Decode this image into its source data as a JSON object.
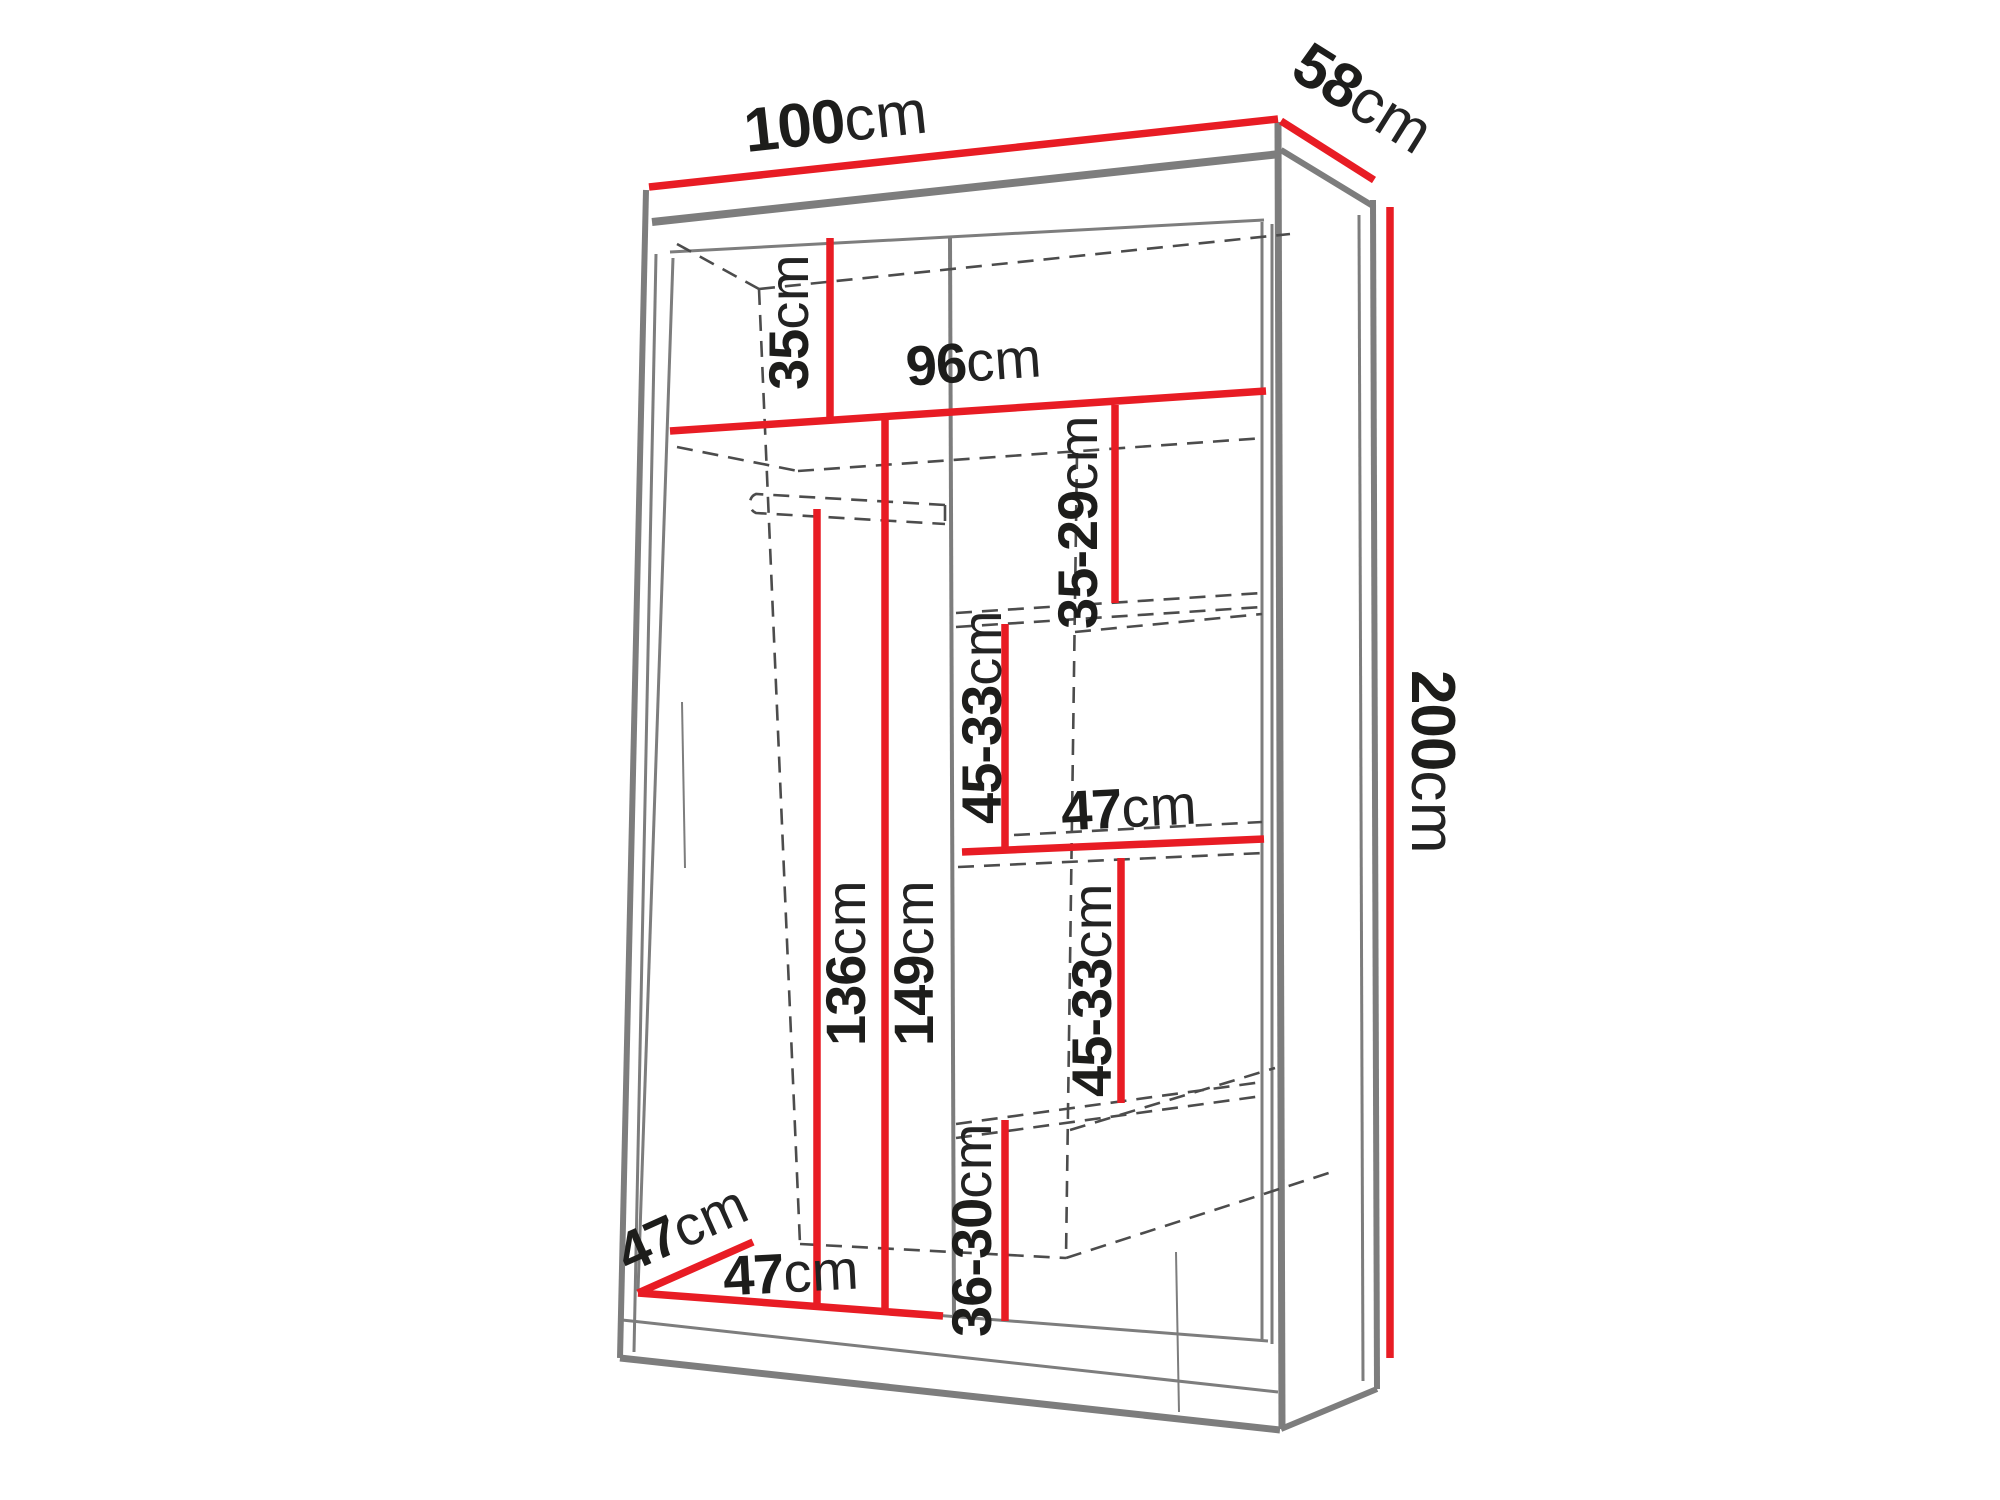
{
  "diagram": {
    "subject": "wardrobe-dimension-drawing",
    "unit": "cm",
    "accent_color": "#e81c24",
    "outline_color": "#7d7d7d",
    "hidden_edge_color": "#4c4c4c",
    "dimensions": {
      "width": {
        "value": "100",
        "unit": "cm",
        "role": "exterior width (top front edge)"
      },
      "depth": {
        "value": "58",
        "unit": "cm",
        "role": "exterior depth (top right edge)"
      },
      "height": {
        "value": "200",
        "unit": "cm",
        "role": "exterior height (right side)"
      },
      "top_section": {
        "value": "35",
        "unit": "cm",
        "role": "height of top compartment above full-width shelf"
      },
      "interior_width": {
        "value": "96",
        "unit": "cm",
        "role": "interior width at full-width shelf"
      },
      "gap1": {
        "value": "35-29",
        "unit": "cm",
        "role": "right column shelf spacing 1"
      },
      "gap2": {
        "value": "45-33",
        "unit": "cm",
        "role": "right column shelf spacing 2"
      },
      "right_width": {
        "value": "47",
        "unit": "cm",
        "role": "right column interior width (middle shelf)"
      },
      "gap3": {
        "value": "45-33",
        "unit": "cm",
        "role": "right column shelf spacing 3"
      },
      "gap4": {
        "value": "36-30",
        "unit": "cm",
        "role": "right column shelf spacing 4 (bottom)"
      },
      "hanging_height": {
        "value": "136",
        "unit": "cm",
        "role": "height below hanging rail, left section"
      },
      "left_height": {
        "value": "149",
        "unit": "cm",
        "role": "left section height below full-width shelf"
      },
      "interior_depth": {
        "value": "47",
        "unit": "cm",
        "role": "interior depth (bottom diagonal)"
      },
      "left_width": {
        "value": "47",
        "unit": "cm",
        "role": "left section interior width (bottom)"
      }
    }
  }
}
